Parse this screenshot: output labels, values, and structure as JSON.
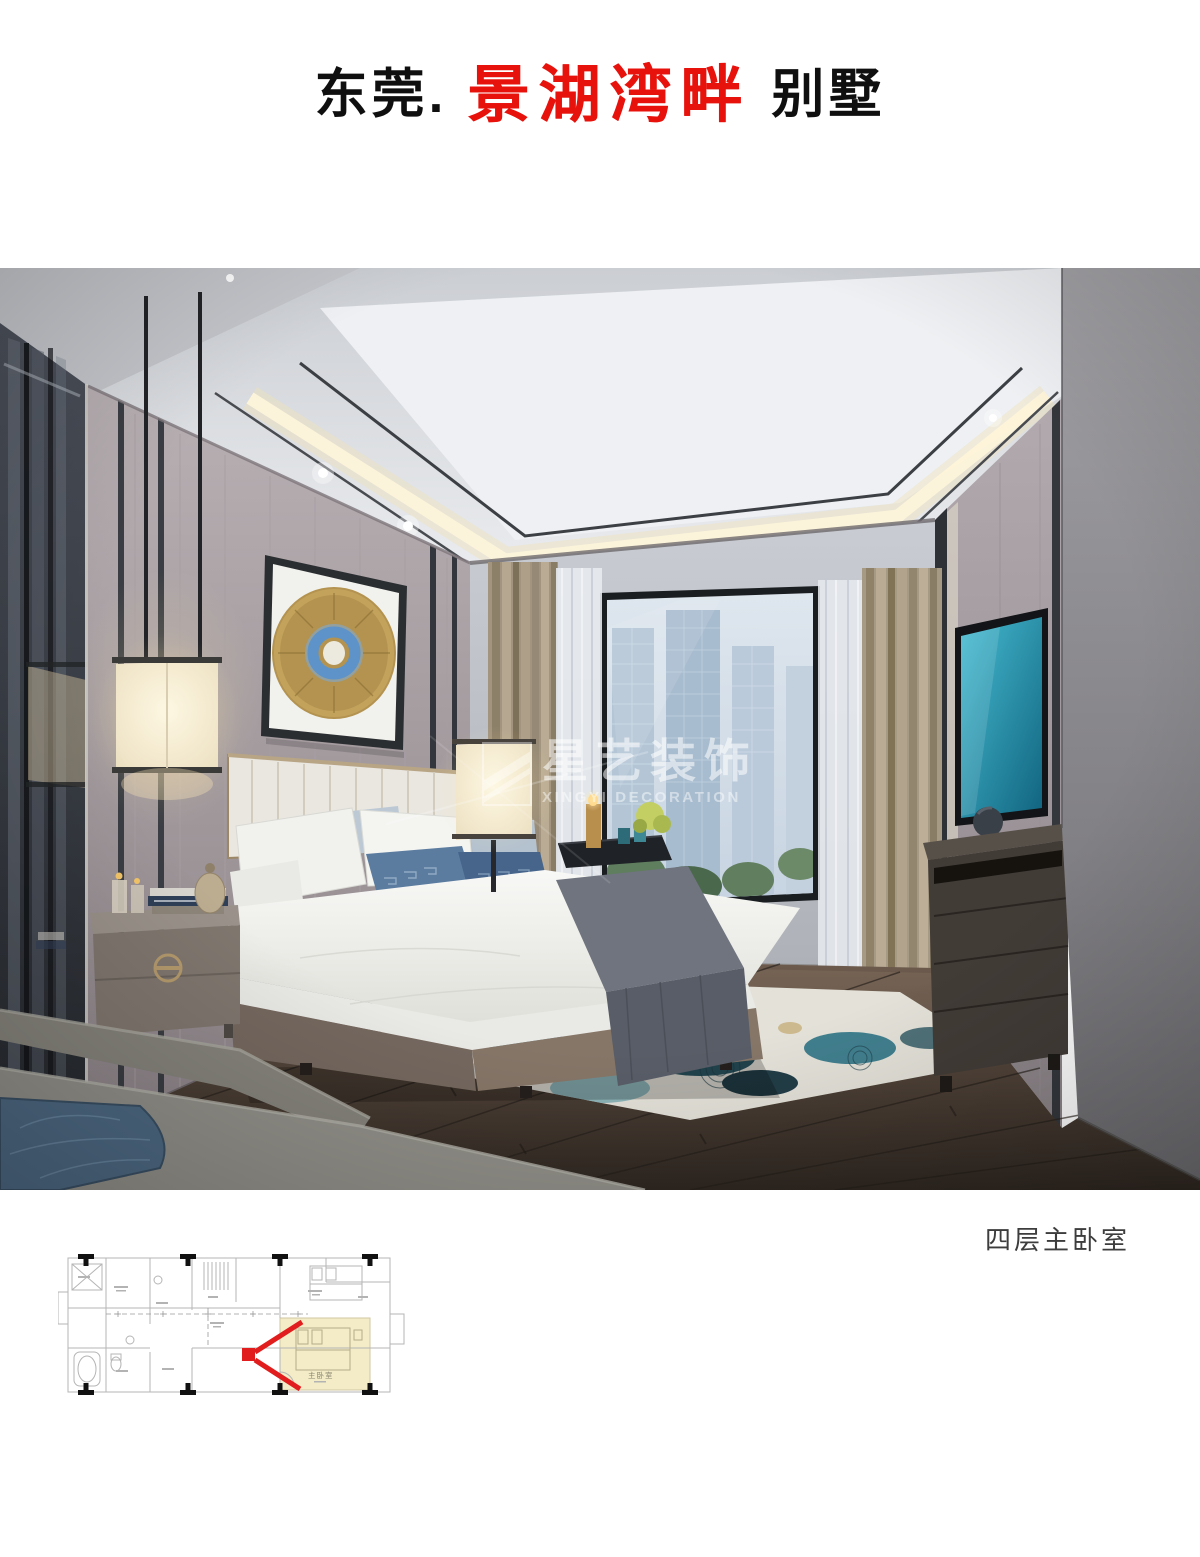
{
  "header": {
    "city": "东莞.",
    "project": "景湖湾畔",
    "suffix": "别墅",
    "project_color": "#e8120d",
    "text_color": "#0f0f0f"
  },
  "watermark": {
    "cn": "星艺装饰",
    "en": "XINGYI DECORATION",
    "color": "rgba(255,255,255,0.55)"
  },
  "caption": "四层主卧室",
  "caption_color": "#3d3d3d",
  "floor_plan": {
    "room_label": "主卧室",
    "label_color": "#8a8370",
    "highlight_color": "#f3ecc6",
    "marker_color": "#e11d1d",
    "line_color": "#b5b5b5",
    "column_color": "#111111"
  }
}
